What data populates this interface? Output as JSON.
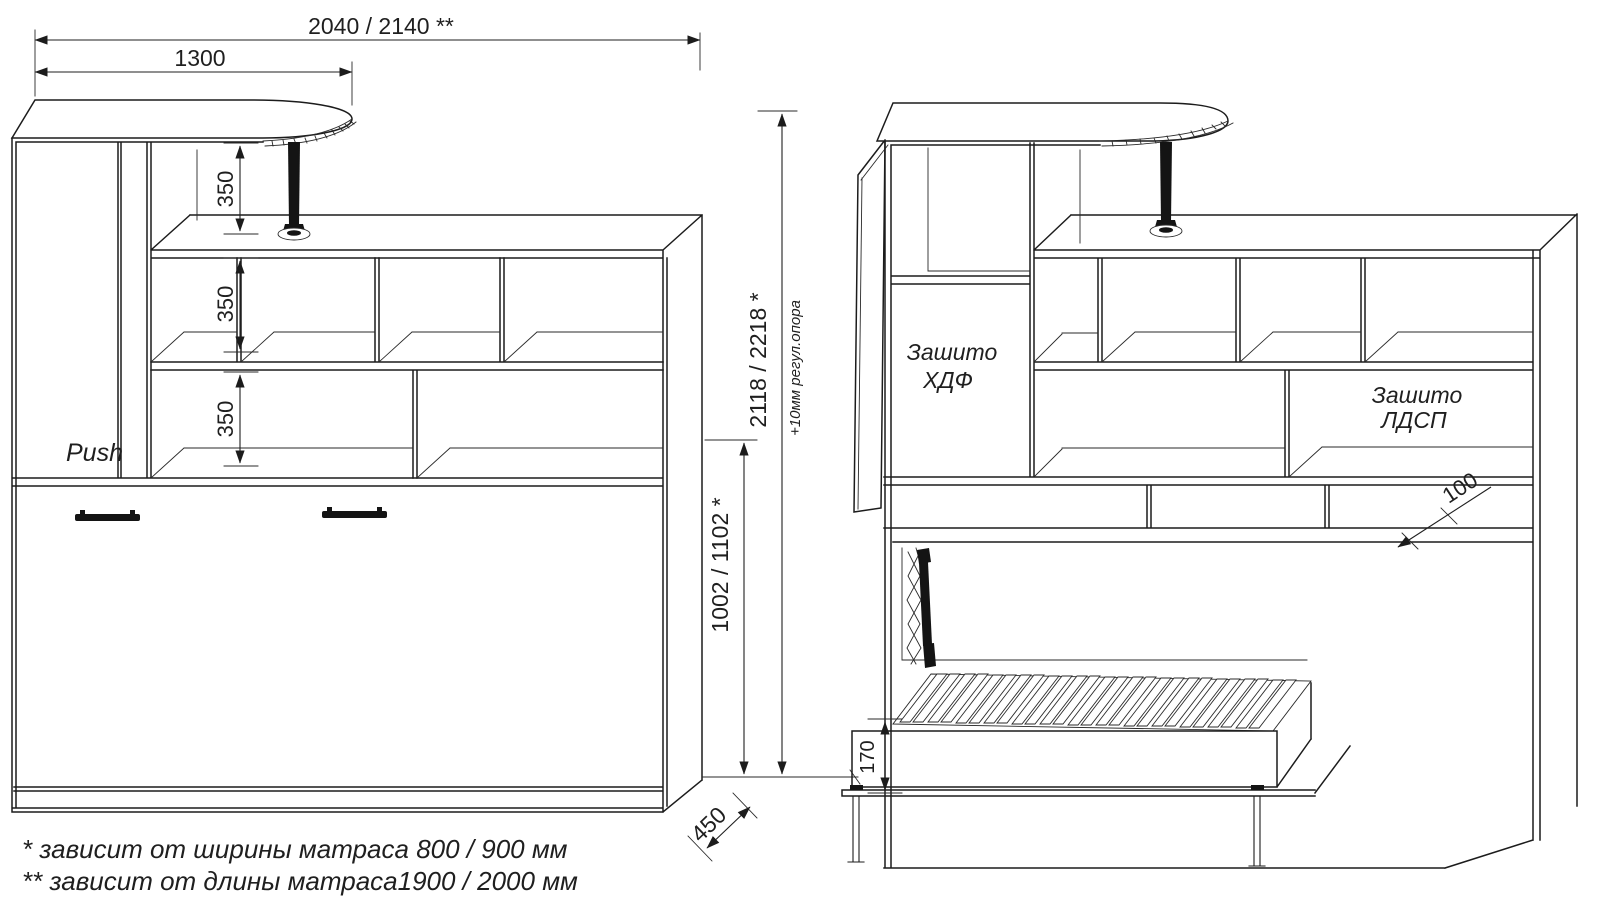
{
  "colors": {
    "line": "#1c1c1c",
    "background": "#ffffff"
  },
  "labels": {
    "push": "Push",
    "sheathed_hdf_line1": "Зашито",
    "sheathed_hdf_line2": "ХДФ",
    "sheathed_ldsp_line1": "Зашито",
    "sheathed_ldsp_line2": "ЛДСП"
  },
  "dimensions": {
    "total_width": "2040 / 2140 **",
    "desk_width": "1300",
    "shelf_gap_1": "350",
    "shelf_gap_2": "350",
    "shelf_gap_3": "350",
    "total_height": "2118 / 2218 *",
    "height_note": "+10мм регул.опора",
    "bed_section_height": "1002 / 1102 *",
    "depth": "450",
    "slat_offset": "100",
    "bed_frame_height": "170"
  },
  "footnotes": [
    "*  зависит от ширины матраса 800 / 900 мм",
    "** зависит от длины матраса1900 / 2000 мм"
  ]
}
